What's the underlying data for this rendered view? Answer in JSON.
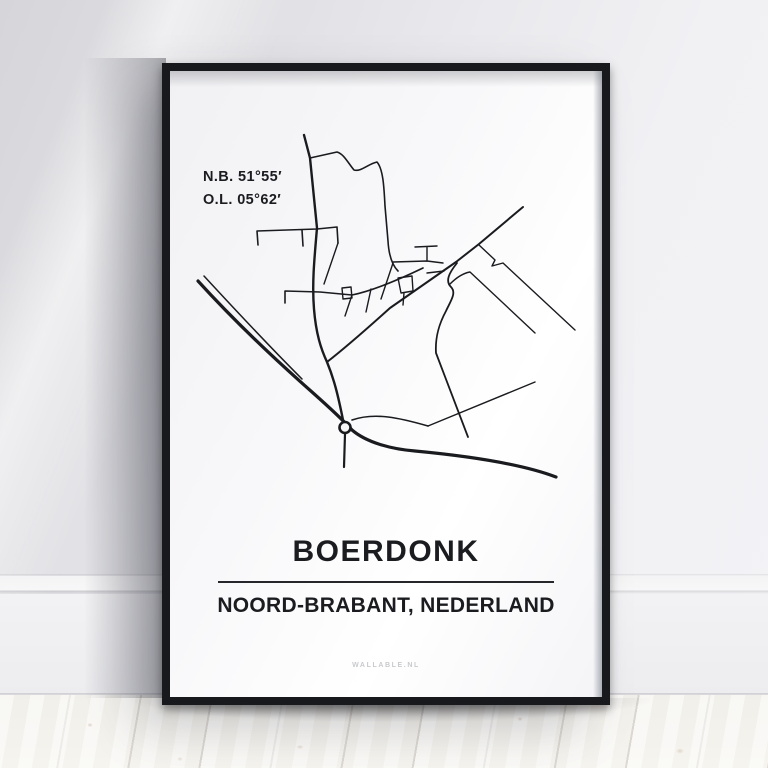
{
  "poster": {
    "coordinates": {
      "latitude": "N.B. 51°55′",
      "longitude": "O.L. 05°62′"
    },
    "title": "BOERDONK",
    "subtitle": "NOORD-BRABANT, NEDERLAND",
    "brand": "WALLABLE.NL"
  },
  "colors": {
    "road": "#1a1b1f",
    "paper": "#f7f7f8",
    "frame": "#17191d",
    "ink": "#1b1c20",
    "brand_text": "#c9cacd"
  },
  "map": {
    "viewBox": "170 71 432 626",
    "roundabout": {
      "cx": 345,
      "cy": 427.5,
      "r": 5.5
    },
    "roads": [
      {
        "d": "M198,281 C238,325 278,362 312,392 C330,408 342,419 352,430 C366,442 390,449 415,451 C468,456 522,464 556,477",
        "w": 3.2
      },
      {
        "d": "M204,276 C240,315 271,348 302,379",
        "w": 1.5
      },
      {
        "d": "M345,434 L344,467",
        "w": 2.2
      },
      {
        "d": "M304,135 L310,158 L317,228 C314,262 312,285 314,309 C316,334 321,349 327,362 C334,379 338,395 343,420",
        "w": 2.4
      },
      {
        "d": "M310,158 L337,152 C344,154 348,163 354,170 C361,172 368,164 377,162 C383,169 384,186 385,206 L388,241 C389,258 393,266 398,271",
        "w": 1.6
      },
      {
        "d": "M257,231 L317,229 M257,231 L258,245 M302,230 L303,246 M317,229 L337,227 L338,243",
        "w": 1.6
      },
      {
        "d": "M338,243 L324,284",
        "w": 1.4
      },
      {
        "d": "M285,291 L285,303 M285,291 L320,292 L352,295 C372,291 398,280 423,268",
        "w": 1.6
      },
      {
        "d": "M327,362 C345,348 370,326 390,308 L456,262 L479,244 L523,207",
        "w": 2
      },
      {
        "d": "M352,295 L345,316 M371,289 L366,312 M393,263 L381,299",
        "w": 1.4
      },
      {
        "d": "M398,278 L412,276 L413,291 L401,293 Z M404,293 L403,305",
        "w": 1.4
      },
      {
        "d": "M342,288 L351,287 L352,298 L343,299 Z",
        "w": 1.4
      },
      {
        "d": "M415,247 L437,246 M427,247 L427,261",
        "w": 1.4
      },
      {
        "d": "M393,262 L427,261 L443,263 M427,273 L444,271",
        "w": 1.4
      },
      {
        "d": "M457,263 C449,273 445,281 451,287 C457,293 450,302 446,311 C439,324 435,337 436,353 L468,437",
        "w": 1.8
      },
      {
        "d": "M352,420 C375,412 400,418 428,426",
        "w": 1.6
      },
      {
        "d": "M428,426 L535,382",
        "w": 1.4
      },
      {
        "d": "M479,245 L495,260 L492,266 L503,263 L575,330",
        "w": 1.4
      },
      {
        "d": "M450,284 C457,277 464,273 470,272 L535,333",
        "w": 1.4
      }
    ]
  }
}
